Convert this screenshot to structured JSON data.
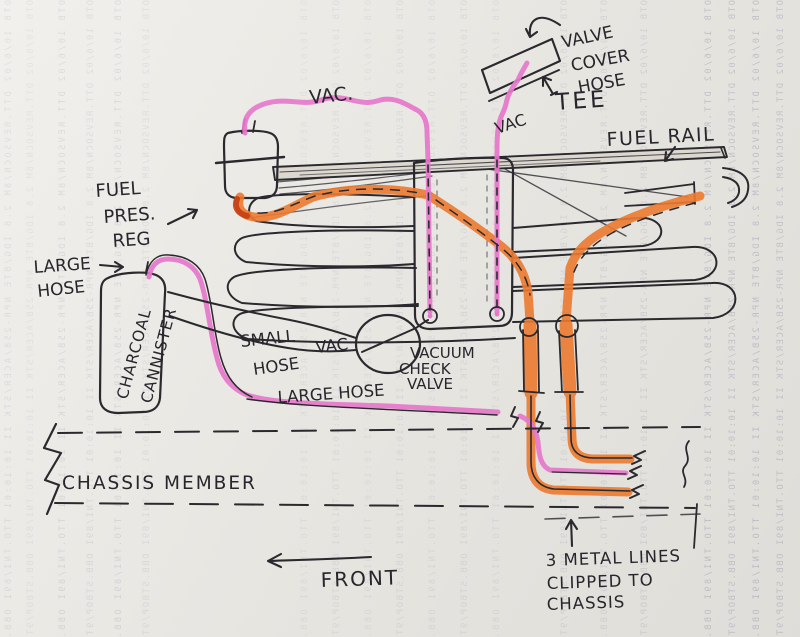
{
  "document": {
    "type": "hand-drawn automotive hose routing sketch on scanned paper",
    "colors": {
      "paper": "#edebe6",
      "ink": "#2a292e",
      "pink_highlighter": "#e678cc",
      "orange_highlighter": "#ec7a2f",
      "orange_shadow": "#c23a10",
      "bleedthrough": "#9a99b2"
    }
  },
  "labels": {
    "vac_top": "VAC.",
    "valve_cover_hose": {
      "l1": "VALVE",
      "l2": "COVER",
      "l3": "HOSE"
    },
    "tee": "TEE",
    "vac_mid": "VAC",
    "fuel_rail": "FUEL RAIL",
    "fuel_pres_reg": {
      "l1": "FUEL",
      "l2": "PRES.",
      "l3": "REG"
    },
    "large_hose_left": {
      "l1": "LARGE",
      "l2": "HOSE"
    },
    "canister": {
      "l1": "CHARCOAL",
      "l2": "CANNISTER"
    },
    "small_vac_hose": {
      "l1": "SMALL",
      "l2": "VAC",
      "l3": "HOSE"
    },
    "vacuum_check_valve": {
      "l1": "VACUUM",
      "l2": "CHECK",
      "l3": "VALVE"
    },
    "large_hose_mid": "LARGE HOSE",
    "chassis_member": "CHASSIS MEMBER",
    "front": "FRONT",
    "metal_lines": {
      "l1": "3 METAL LINES",
      "l2": "CLIPPED TO",
      "l3": "CHASSIS"
    }
  },
  "bleed": {
    "text": "OTB 10/6/02 DTT.REVSOCN/8M 2.8 IDG/BTE NPR-25B/ACER/STK II 10:10:01 TTO.TNI/89I OBB.STBOP/9TD EXB.ZEROCT DTT.POOL-II BHO.OTOTP6 ONE 8M/ATX/5Z8 IIB DTT"
  }
}
